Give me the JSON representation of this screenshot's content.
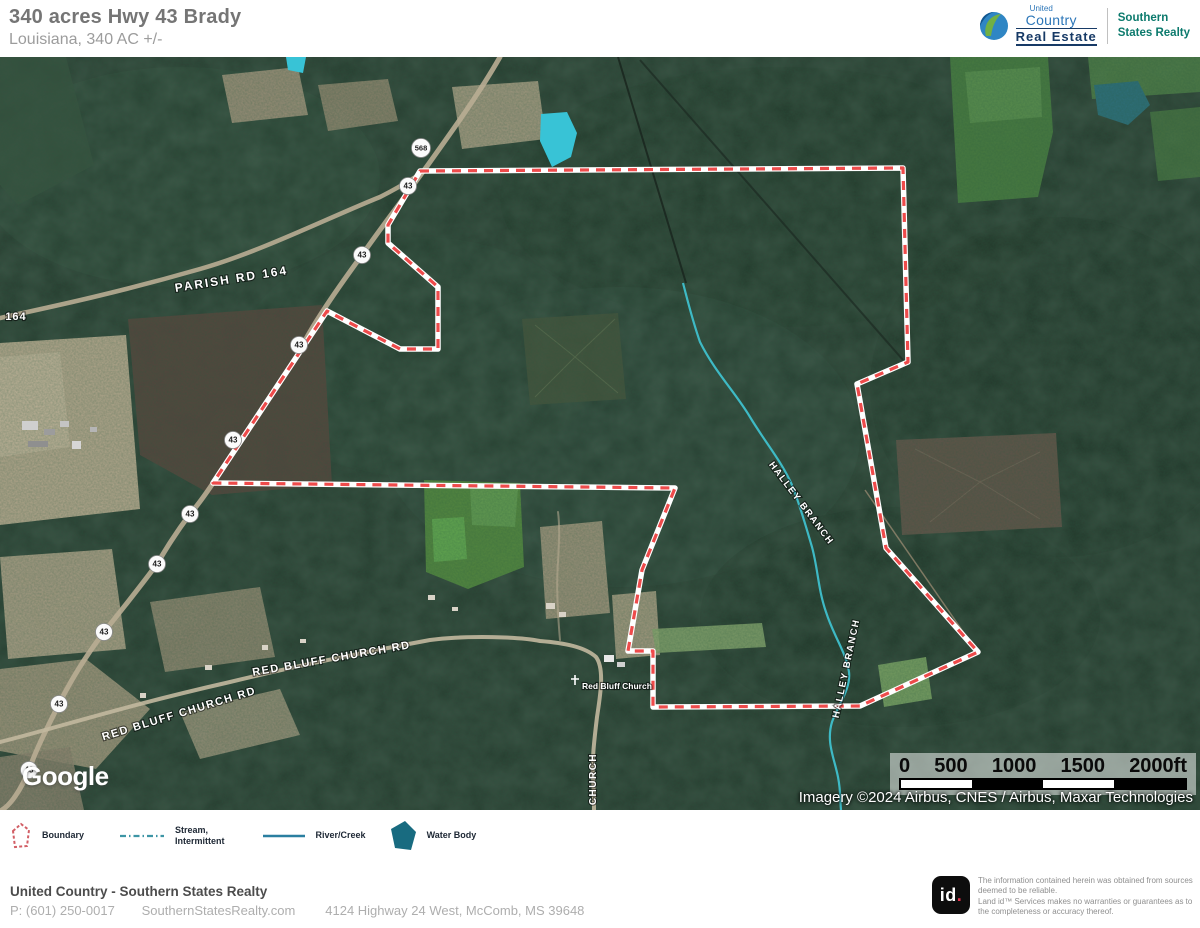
{
  "header": {
    "title": "340 acres Hwy 43 Brady",
    "subtitle": "Louisiana, 340 AC +/-",
    "brand": {
      "united": "United",
      "country": "Country",
      "real_estate": "Real Estate",
      "southern_line1": "Southern",
      "southern_line2": "States Realty"
    }
  },
  "map": {
    "labels": {
      "parish_rd": "PARISH RD 164",
      "rd_164": "164",
      "red_bluff_church_rd": "RED BLUFF CHURCH RD",
      "church_rd_vertical": "CHURCH",
      "church_poi": "Red Bluff Church",
      "creek": "HALLEY BRANCH"
    },
    "shields": [
      "568",
      "43",
      "43",
      "43",
      "43",
      "43",
      "43",
      "43",
      "43",
      "43"
    ],
    "google": "Google",
    "attribution": "Imagery ©2024 Airbus, CNES / Airbus, Maxar Technologies",
    "scale_ticks": [
      "0",
      "500",
      "1000",
      "1500",
      "2000ft"
    ]
  },
  "legend": {
    "boundary": "Boundary",
    "stream_line1": "Stream,",
    "stream_line2": "Intermittent",
    "river": "River/Creek",
    "water": "Water Body"
  },
  "footer": {
    "company": "United Country - Southern States Realty",
    "phone": "P: (601) 250-0017",
    "website": "SouthernStatesRealty.com",
    "address": "4124 Highway 24 West, McComb, MS 39648",
    "landid_text": "id",
    "landid_dot": ".",
    "disclaimer_line1": "The information contained herein was obtained from sources deemed to be reliable.",
    "disclaimer_line2": "Land id™ Services makes no warranties or guarantees as to the completeness or accuracy thereof."
  },
  "colors": {
    "boundary_red": "#ee4b4b",
    "creek_teal": "#3fc0cc",
    "water_body_fill": "#186b80",
    "brand_navy": "#173a66",
    "brand_teal": "#0c7a6d",
    "pond_cyan": "#38c3d6"
  }
}
